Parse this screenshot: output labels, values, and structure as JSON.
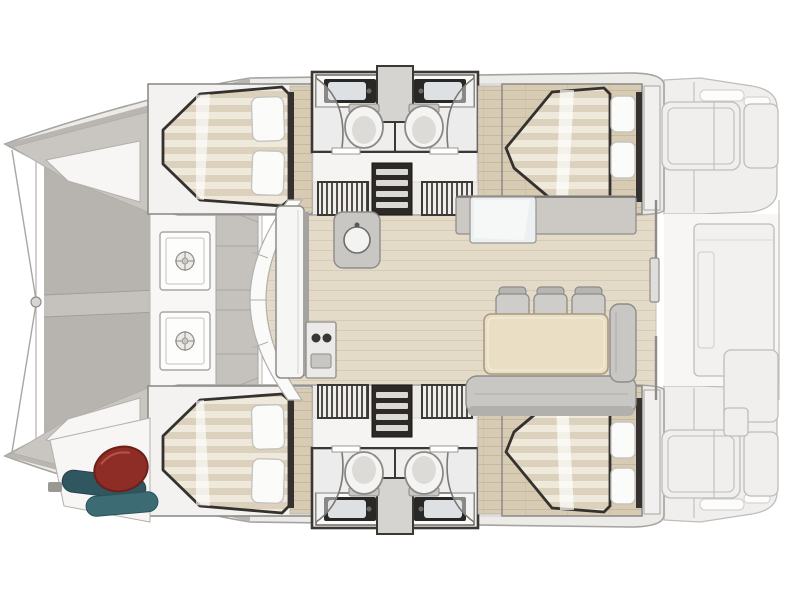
{
  "page": {
    "background": "#ffffff"
  },
  "palette": {
    "white": "#ffffff",
    "hull_fill": "#ecebe8",
    "hull_stroke": "#a6a4a1",
    "gunwale": "#b9b6b2",
    "deck_gray": "#c9c6c2",
    "tramp": "#b7b3af",
    "tramp_seam": "#c5c2be",
    "wall_dark": "#3a3734",
    "bed_stroke": "#34312e",
    "wood": "#d7cbb3",
    "wood_line": "#c6b99e",
    "wood_light": "#e3dac8",
    "wood_light_line": "#d6cbb6",
    "mattress_a": "#efe9db",
    "mattress_b": "#dbd1bc",
    "pillow": "#fbfbf9",
    "furn_gray": "#c9c7c3",
    "furn_stroke": "#8e8c89",
    "ghost_fill": "#f0efed",
    "ghost_stroke": "#bfbdba",
    "table": "#eadfc4",
    "table_stroke": "#a89a7d",
    "fridge": "#edf0f1",
    "sink_dark": "#2a2826",
    "basin": "#dde1e3",
    "toilet": "#f4f4f2",
    "fender_red": "#8e2d25",
    "teal_dark": "#30565f",
    "teal": "#3d6b74"
  },
  "floor_plan": {
    "description": "Top-down floor plan of a four-cabin sailing catamaran, bow to the left, stern to the right",
    "vessel_type": "sailing catamaran",
    "view": "top-down interior layout",
    "bow_direction": "left",
    "counts": {
      "cabins": 4,
      "heads": 4,
      "toilets": 4,
      "bathroom_sinks": 4,
      "pillows": 8,
      "deck_hatches": 2,
      "dining_chairs": 3
    },
    "bow": {
      "trampoline": "bow trampoline with centre seam",
      "bridle": "forestay bridle lines with ring",
      "crossbeam": "forward crossbeam"
    },
    "foredeck": {
      "hatches": [
        "deck hatch",
        "deck hatch"
      ],
      "panels": "moulded deck panels"
    },
    "port_hull": {
      "forward_cabin": "double berth with two pillows",
      "forward_head": "vanity sink, shower, toilet",
      "aft_head": "vanity sink, shower, toilet",
      "lockers": "two hanging lockers",
      "steps": "companionway steps",
      "aft_cabin": "double berth with two pillows"
    },
    "starboard_hull": {
      "forward_cabin": "double berth with two pillows",
      "forward_head": "vanity sink, shower, toilet",
      "aft_head": "vanity sink, shower, toilet",
      "lockers": "two hanging lockers",
      "steps": "companionway steps",
      "aft_cabin": "double berth with two pillows",
      "forepeak_locker": [
        "red fender",
        "teal sail bag",
        "teal sail bag"
      ]
    },
    "saloon": {
      "galley": [
        "forward counter along windshield",
        "stove with two burners",
        "round sink",
        "refrigerator unit",
        "aft counter"
      ],
      "dining": [
        "rectangular table",
        "three chairs",
        "L-shaped settee"
      ],
      "aft_door": "sliding door to cockpit"
    },
    "cockpit": {
      "ghosted": true,
      "items": [
        "port bench",
        "starboard bench",
        "helm seat",
        "central platform",
        "transom swim steps"
      ]
    }
  }
}
